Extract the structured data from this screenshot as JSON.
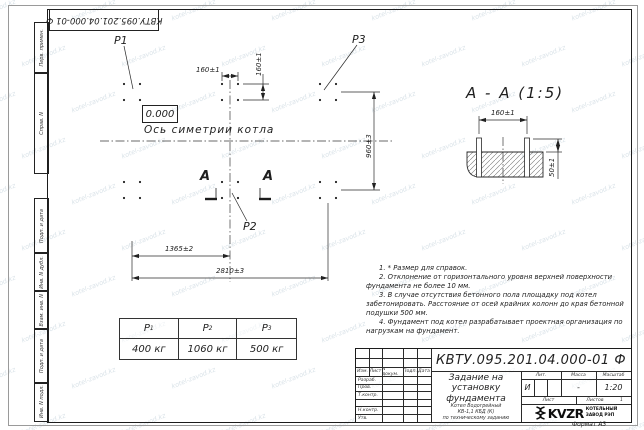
{
  "watermark": {
    "text": "kotel-zavod.kz"
  },
  "top_stamp": {
    "doc_number": "КВТУ.095.201.04.000-01 Ф"
  },
  "side_strip": {
    "items": [
      "Перв. примен.",
      "Справ. N",
      "Подп. и дата",
      "Инв. N дубл.",
      "Взам. инв. N",
      "Подп. и дата",
      "Инв. N подл."
    ]
  },
  "plan": {
    "p1": "P1",
    "p2": "P2",
    "p3": "P3",
    "elevation": "0.000",
    "axis_label": "Ось симетрии котла",
    "section_letter": "А",
    "dim_160_h": "160±1",
    "dim_160_v": "160±1",
    "dim_960": "960±3",
    "dim_1365": "1365±2",
    "dim_2810": "2810±3"
  },
  "section_view": {
    "title": "А - А (1:5)",
    "dim_160": "160±1",
    "dim_50": "50±1"
  },
  "loads_table": {
    "headers": [
      {
        "base": "P",
        "sub": "1"
      },
      {
        "base": "P",
        "sub": "2"
      },
      {
        "base": "P",
        "sub": "3"
      }
    ],
    "values": [
      "400 кг",
      "1060 кг",
      "500 кг"
    ]
  },
  "notes": [
    "1. * Размер для справок.",
    "2. Отклонение от горизонтального уровня верхней поверхности фундамента не более 10 мм.",
    "3. В случае отсутствия бетонного пола площадку под котел забетонировать. Расстояние от осей крайних колонн до края бетонной подушки 500 мм.",
    "4. Фундамент под котел разрабатывает проектная организация по нагрузкам на фундамент."
  ],
  "title_block": {
    "doc_number": "КВТУ.095.201.04.000-01 Ф",
    "title": "Задание на установку фундамента",
    "subtitle_1": "Котел Водогрейный",
    "subtitle_2": "КВ-1,1 КБД (К)",
    "subtitle_3": "по техническому заданию",
    "columns": {
      "izm": "Изм.",
      "list": "Лист",
      "doc": "N докум.",
      "podp": "Подп.",
      "data": "Дата"
    },
    "rows": {
      "razrab": "Разраб.",
      "prov": "Пров.",
      "tkontr": "Т.контр.",
      "nkontr": "Н.контр.",
      "utv": "Утв."
    },
    "lit_header": "Лит.",
    "lit_value": "И",
    "mass_header": "Масса",
    "mass_value": "-",
    "scale_header": "Масштаб",
    "scale_value": "1:20",
    "sheet_label": "Лист",
    "sheets_label": "Листов",
    "sheets_value": "1",
    "logo_text": "KVZR",
    "logo_caption_1": "КОТЕЛЬНЫЙ",
    "logo_caption_2": "ЗАВОД РЭП",
    "format_label": "Формат А3"
  }
}
